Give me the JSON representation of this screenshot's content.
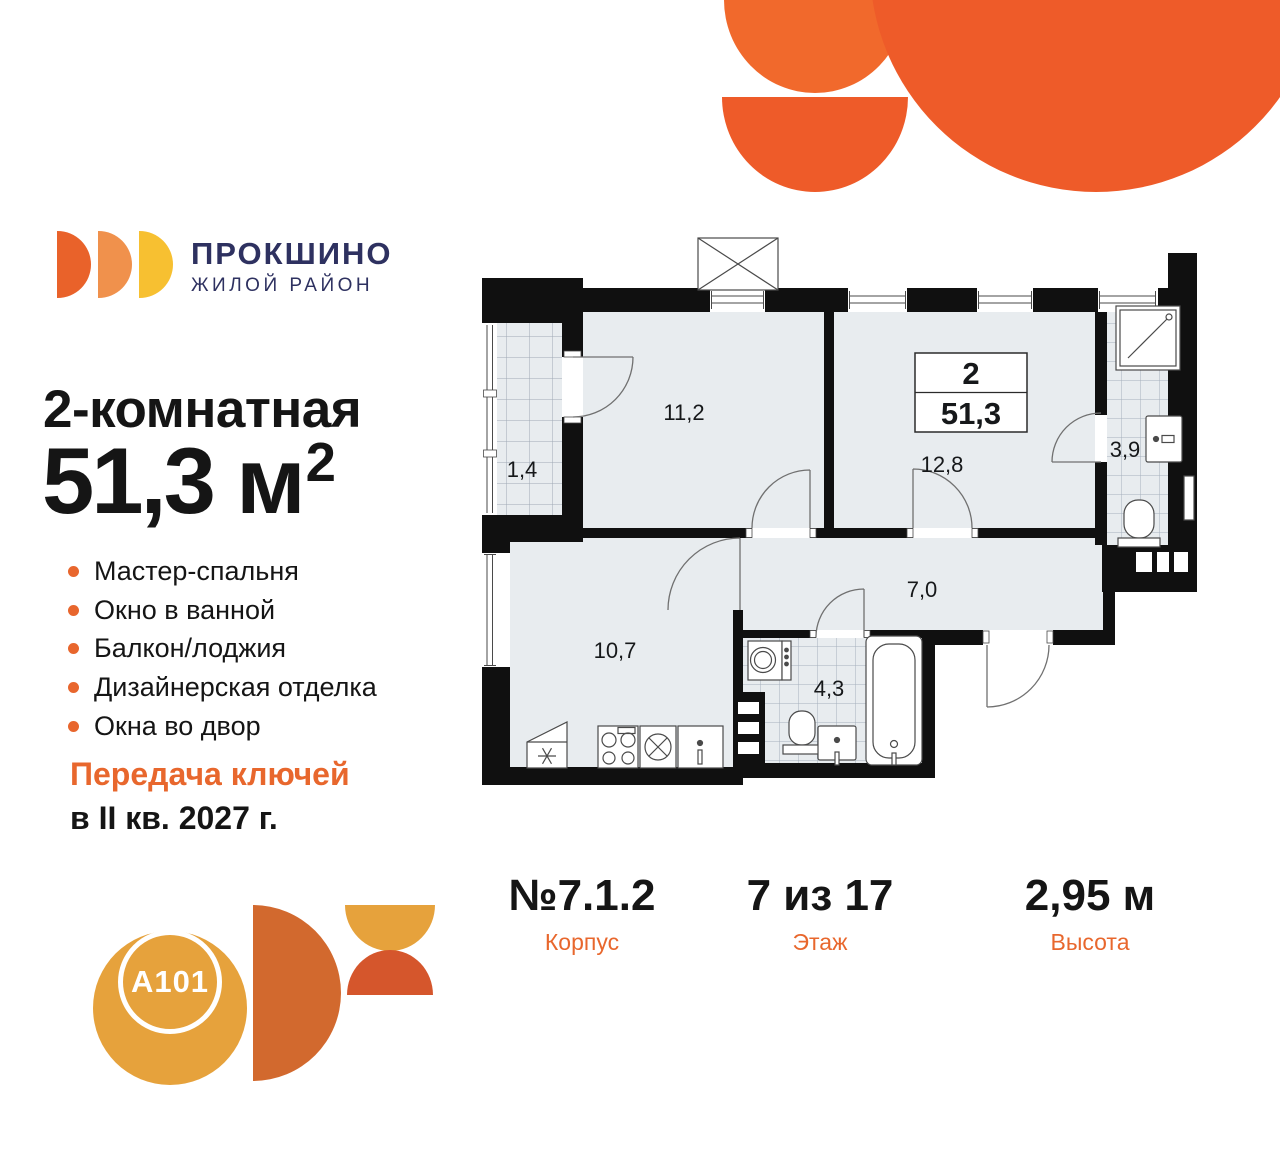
{
  "brand": {
    "name": "ПРОКШИНО",
    "tagline": "ЖИЛОЙ РАЙОН"
  },
  "listing": {
    "rooms_title": "2-комнатная",
    "area_value": "51,3 м",
    "area_sup": "2",
    "features": [
      "Мастер-спальня",
      "Окно в ванной",
      "Балкон/лоджия",
      "Дизайнерская отделка",
      "Окна во двор"
    ],
    "handover_line1": "Передача ключей",
    "handover_line2": "в II кв. 2027 г."
  },
  "plan": {
    "info_box": {
      "rooms": "2",
      "area": "51,3"
    },
    "rooms": {
      "balcony": "1,4",
      "bedroom": "11,2",
      "living_room": "12,8",
      "bathroom_small": "3,9",
      "hallway": "7,0",
      "kitchen": "10,7",
      "bathroom_big": "4,3"
    },
    "fixtures": [
      "shower",
      "sink",
      "towel-rail",
      "toilet",
      "washing-machine",
      "bathtub",
      "fridge",
      "stove",
      "kitchen-sink",
      "vent-shaft"
    ]
  },
  "footer": {
    "columns": [
      {
        "value": "№7.1.2",
        "label": "Корпус"
      },
      {
        "value": "7 из 17",
        "label": "Этаж"
      },
      {
        "value": "2,95 м",
        "label": "Высота"
      }
    ]
  },
  "developer": {
    "logo_text": "A101"
  },
  "colors": {
    "accent_orange": "#E8662D",
    "decor_orange": "#EE5B29",
    "decor_orange_light": "#F1692C",
    "brand_navy": "#2E3160",
    "logo_orange_dark": "#E9622A",
    "logo_orange_mid": "#F0914C",
    "logo_yellow": "#F7C031",
    "a101_gold": "#E6A23C",
    "a101_rust": "#D2692E",
    "a101_red": "#D5562C",
    "plan_floor": "#E8ECEF",
    "plan_wall": "#101010"
  }
}
